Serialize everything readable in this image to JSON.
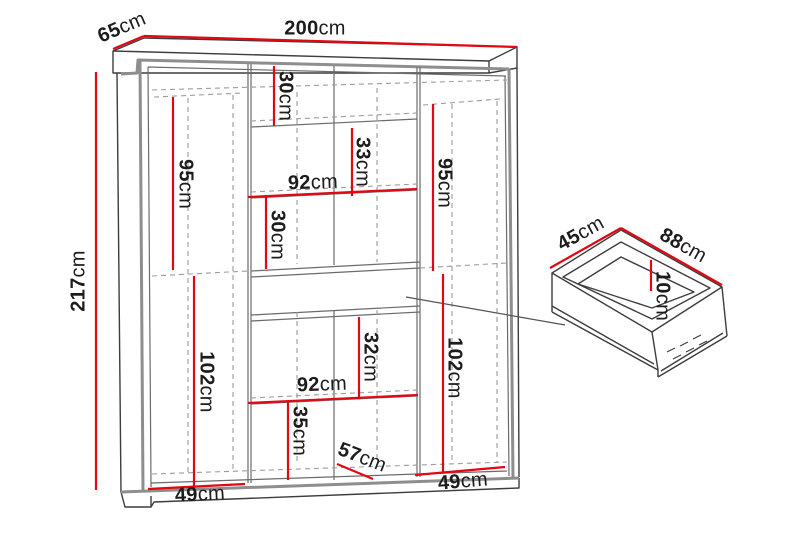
{
  "diagram": {
    "type": "furniture technical drawing",
    "subject": "wardrobe with interior shelving and detail view of drawer",
    "unit": "cm"
  },
  "colors": {
    "dimension_red": "#e30613",
    "outline_dark": "#3d3d3d",
    "frame_gray": "#8e8e8e",
    "hidden_dash": "#9c9c9c",
    "text": "#1c1c1c",
    "background": "#ffffff"
  },
  "dims": {
    "d200": {
      "value": "200",
      "unit": "cm"
    },
    "d65": {
      "value": "65",
      "unit": "cm"
    },
    "d217": {
      "value": "217",
      "unit": "cm"
    },
    "d95l": {
      "value": "95",
      "unit": "cm"
    },
    "d30a": {
      "value": "30",
      "unit": "cm"
    },
    "d33": {
      "value": "33",
      "unit": "cm"
    },
    "d92a": {
      "value": "92",
      "unit": "cm"
    },
    "d30b": {
      "value": "30",
      "unit": "cm"
    },
    "d95r": {
      "value": "95",
      "unit": "cm"
    },
    "d102l": {
      "value": "102",
      "unit": "cm"
    },
    "d32": {
      "value": "32",
      "unit": "cm"
    },
    "d92b": {
      "value": "92",
      "unit": "cm"
    },
    "d35": {
      "value": "35",
      "unit": "cm"
    },
    "d57": {
      "value": "57",
      "unit": "cm"
    },
    "d49l": {
      "value": "49",
      "unit": "cm"
    },
    "d102r": {
      "value": "102",
      "unit": "cm"
    },
    "d49r": {
      "value": "49",
      "unit": "cm"
    },
    "d45": {
      "value": "45",
      "unit": "cm"
    },
    "d88": {
      "value": "88",
      "unit": "cm"
    },
    "d10": {
      "value": "10",
      "unit": "cm"
    }
  }
}
